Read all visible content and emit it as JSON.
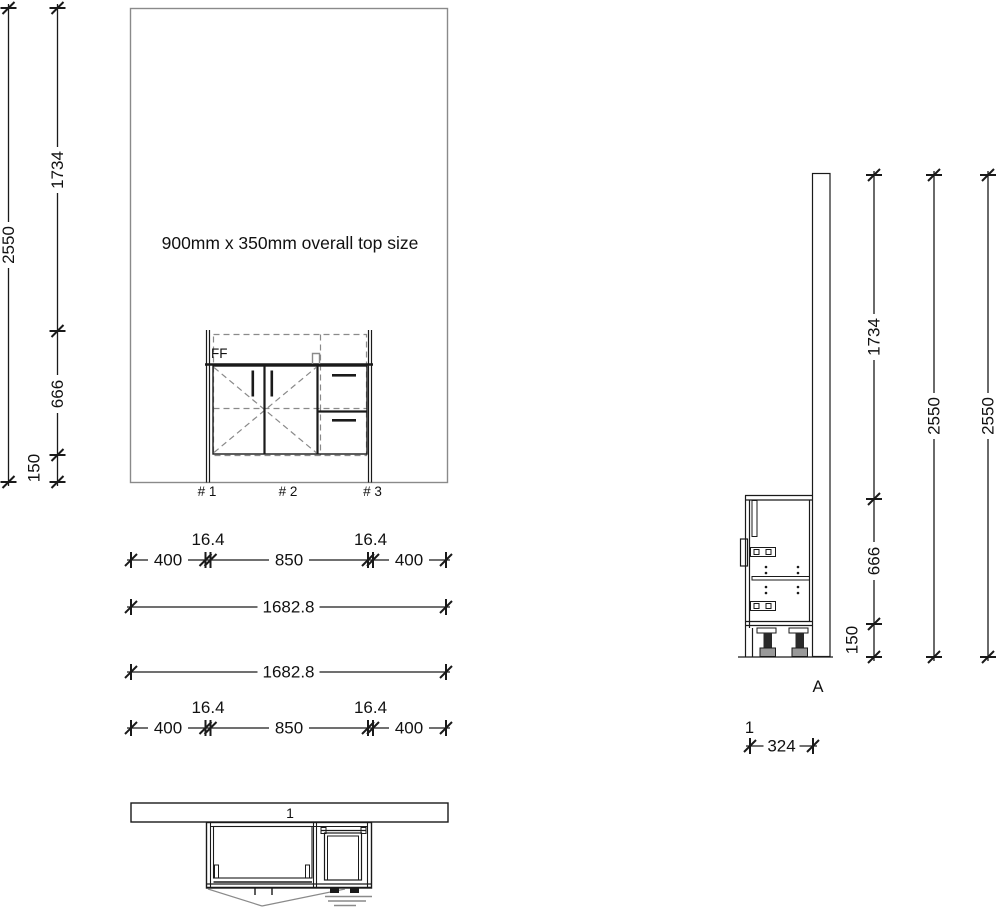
{
  "meta": {
    "background": "#ffffff",
    "line_color": "#1a1a1a",
    "muted_line_color": "#8a8a8a"
  },
  "front_elevation": {
    "annotation": "900mm x 350mm overall top size",
    "cabinet_label": "FF",
    "position_labels": [
      "# 1",
      "# 2",
      "# 3"
    ],
    "dims_vertical": {
      "total": "2550",
      "upper": "1734",
      "middle": "666",
      "plinth": "150"
    },
    "dims_horizontal": {
      "left_offset": "400",
      "panel_thickness": "16.4",
      "cabinet_width": "850",
      "right_offset": "400",
      "overall": "1682.8"
    }
  },
  "plan_view": {
    "wall_label": "1"
  },
  "side_elevation": {
    "section_label": "A",
    "item_label": "1",
    "dims_vertical": {
      "upper": "1734",
      "middle": "666",
      "plinth": "150",
      "total": "2550"
    },
    "dims_horizontal": {
      "depth": "324"
    }
  }
}
